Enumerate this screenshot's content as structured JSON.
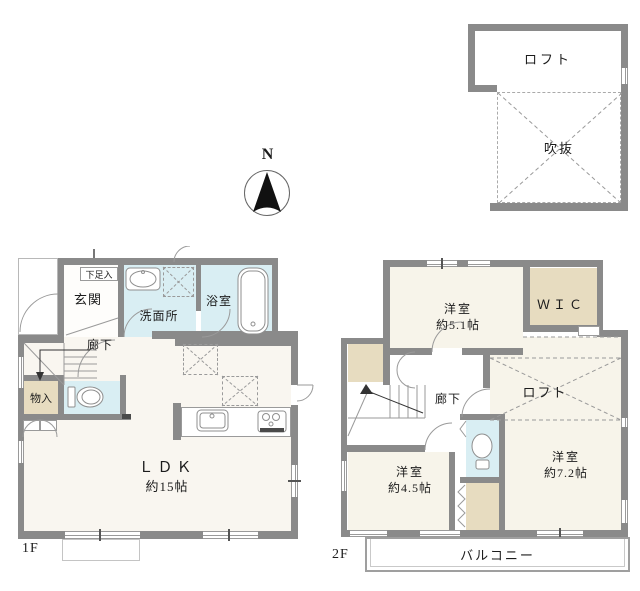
{
  "colors": {
    "wall": "#8a8a8a",
    "line": "#9a9a9a",
    "water": "#d9eef3",
    "tan": "#e7dcc0",
    "floor1": "#f9f6f0",
    "floor2": "#f7f4ea"
  },
  "compass": {
    "north_label": "N"
  },
  "loft_section": {
    "loft_label": "ロフト",
    "void_label": "吹抜"
  },
  "floor1": {
    "floor_label": "1F",
    "rooms": {
      "shoe_cupboard": "下足入",
      "entrance": "玄関",
      "washroom": "洗面所",
      "bathroom": "浴室",
      "hallway": "廊下",
      "storage": "物入",
      "ldk": "ＬＤＫ",
      "ldk_size": "約15帖"
    }
  },
  "floor2": {
    "floor_label": "2F",
    "rooms": {
      "bedroom_a": "洋室",
      "bedroom_a_size": "約5.1帖",
      "wic": "ＷＩＣ",
      "loft": "ロフト",
      "hallway": "廊下",
      "bedroom_b": "洋室",
      "bedroom_b_size": "約4.5帖",
      "bedroom_c": "洋室",
      "bedroom_c_size": "約7.2帖",
      "balcony": "バルコニー"
    }
  }
}
